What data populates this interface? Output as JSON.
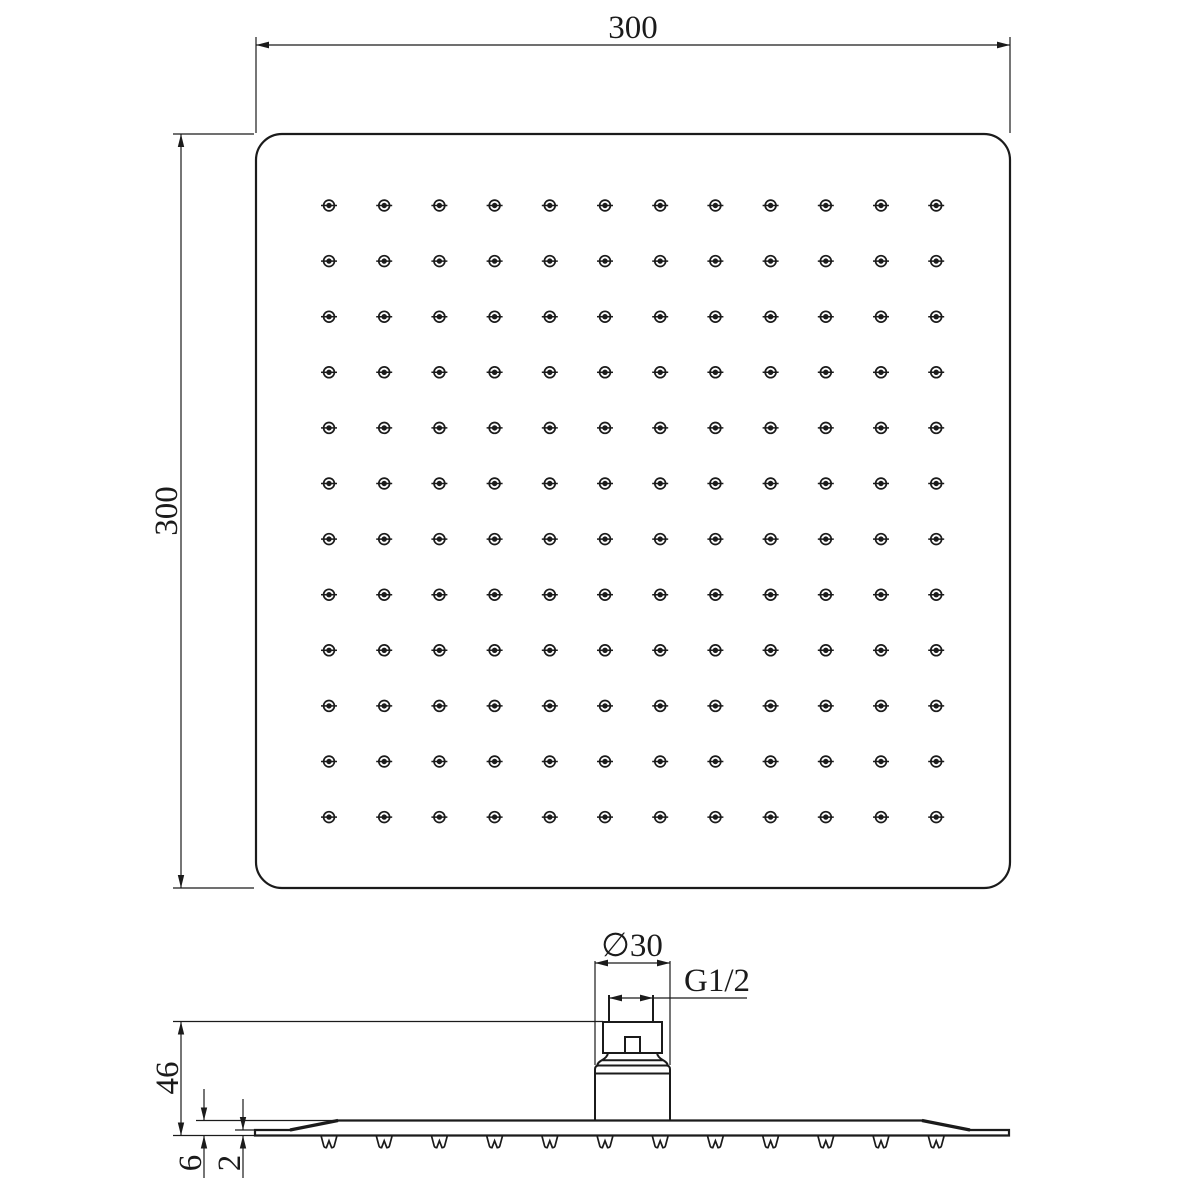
{
  "colors": {
    "background": "#ffffff",
    "line": "#1b1b1b"
  },
  "top_view": {
    "width_label": "300",
    "height_label": "300",
    "grid": {
      "rows": 12,
      "cols": 12
    }
  },
  "side_view": {
    "diameter_label": "∅30",
    "thread_label": "G1/2",
    "overall_height_label": "46",
    "plate_thickness_label": "6",
    "edge_thickness_label": "2",
    "nozzle_count": 12
  }
}
